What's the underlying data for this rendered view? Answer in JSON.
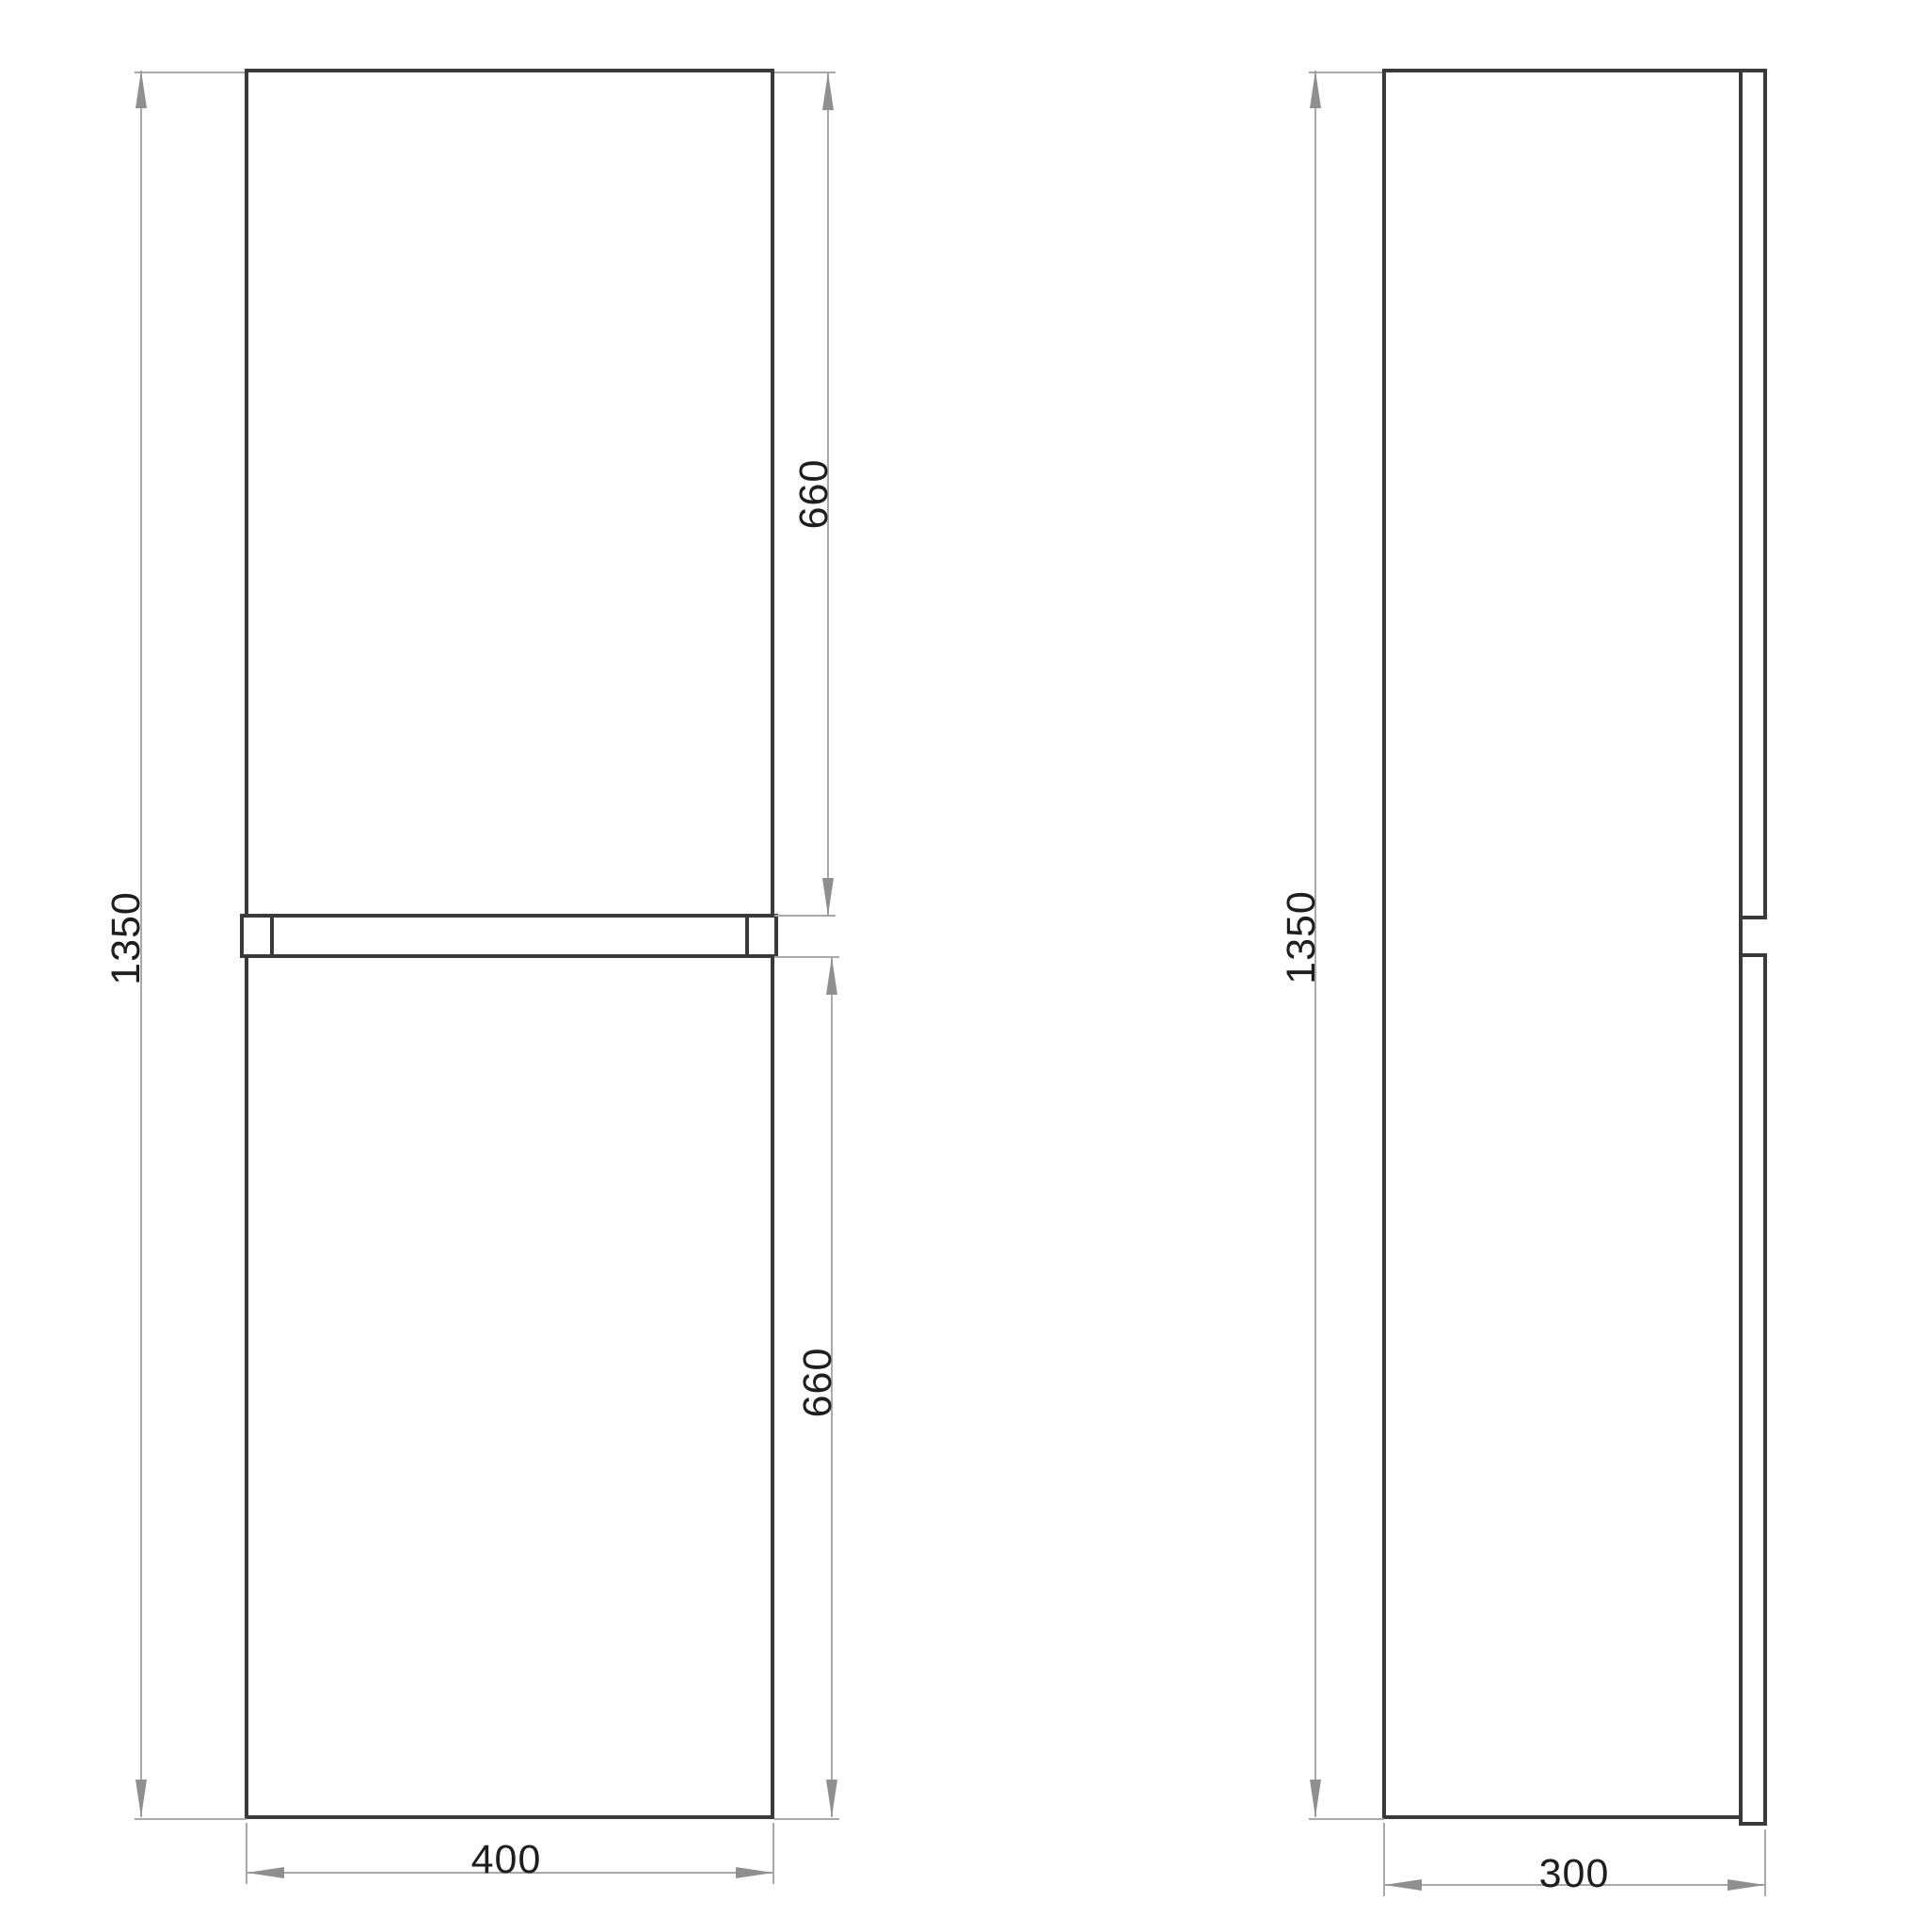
{
  "views": {
    "front": {
      "overall_height": "1350",
      "upper_door_height": "660",
      "lower_door_height": "660",
      "width": "400"
    },
    "side": {
      "overall_height": "1350",
      "depth": "300"
    }
  },
  "colors": {
    "outline": "#3a3a3a",
    "dimension": "#a9a9a9",
    "arrow": "#8f8f8f",
    "text": "#1e1e1e",
    "background": "#ffffff"
  }
}
